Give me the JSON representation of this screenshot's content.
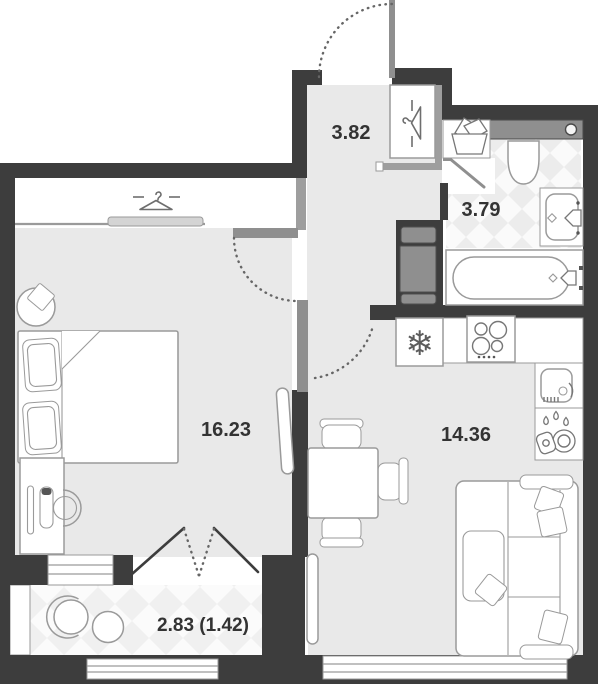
{
  "plan": {
    "type": "apartment-floor-plan",
    "rooms": [
      {
        "name": "hallway",
        "area": "3.82"
      },
      {
        "name": "bathroom",
        "area": "3.79"
      },
      {
        "name": "bedroom",
        "area": "16.23"
      },
      {
        "name": "kitchen-living-room",
        "area": "14.36"
      },
      {
        "name": "balcony",
        "area": "2.83 (1.42)"
      }
    ],
    "glyphs": {
      "snowflake": "❄"
    },
    "colors": {
      "wall": "#3d3d3d",
      "floor": "#e9e9e9",
      "tile": "#ececec",
      "balconyTile": "#f0f0f0",
      "outline": "#9a9a9a",
      "grayWall": "#9e9e9e",
      "door": "#8f8f8f",
      "iconInk": "#777777",
      "dark": "#555555",
      "arc": "#666666",
      "text": "#333333"
    }
  }
}
